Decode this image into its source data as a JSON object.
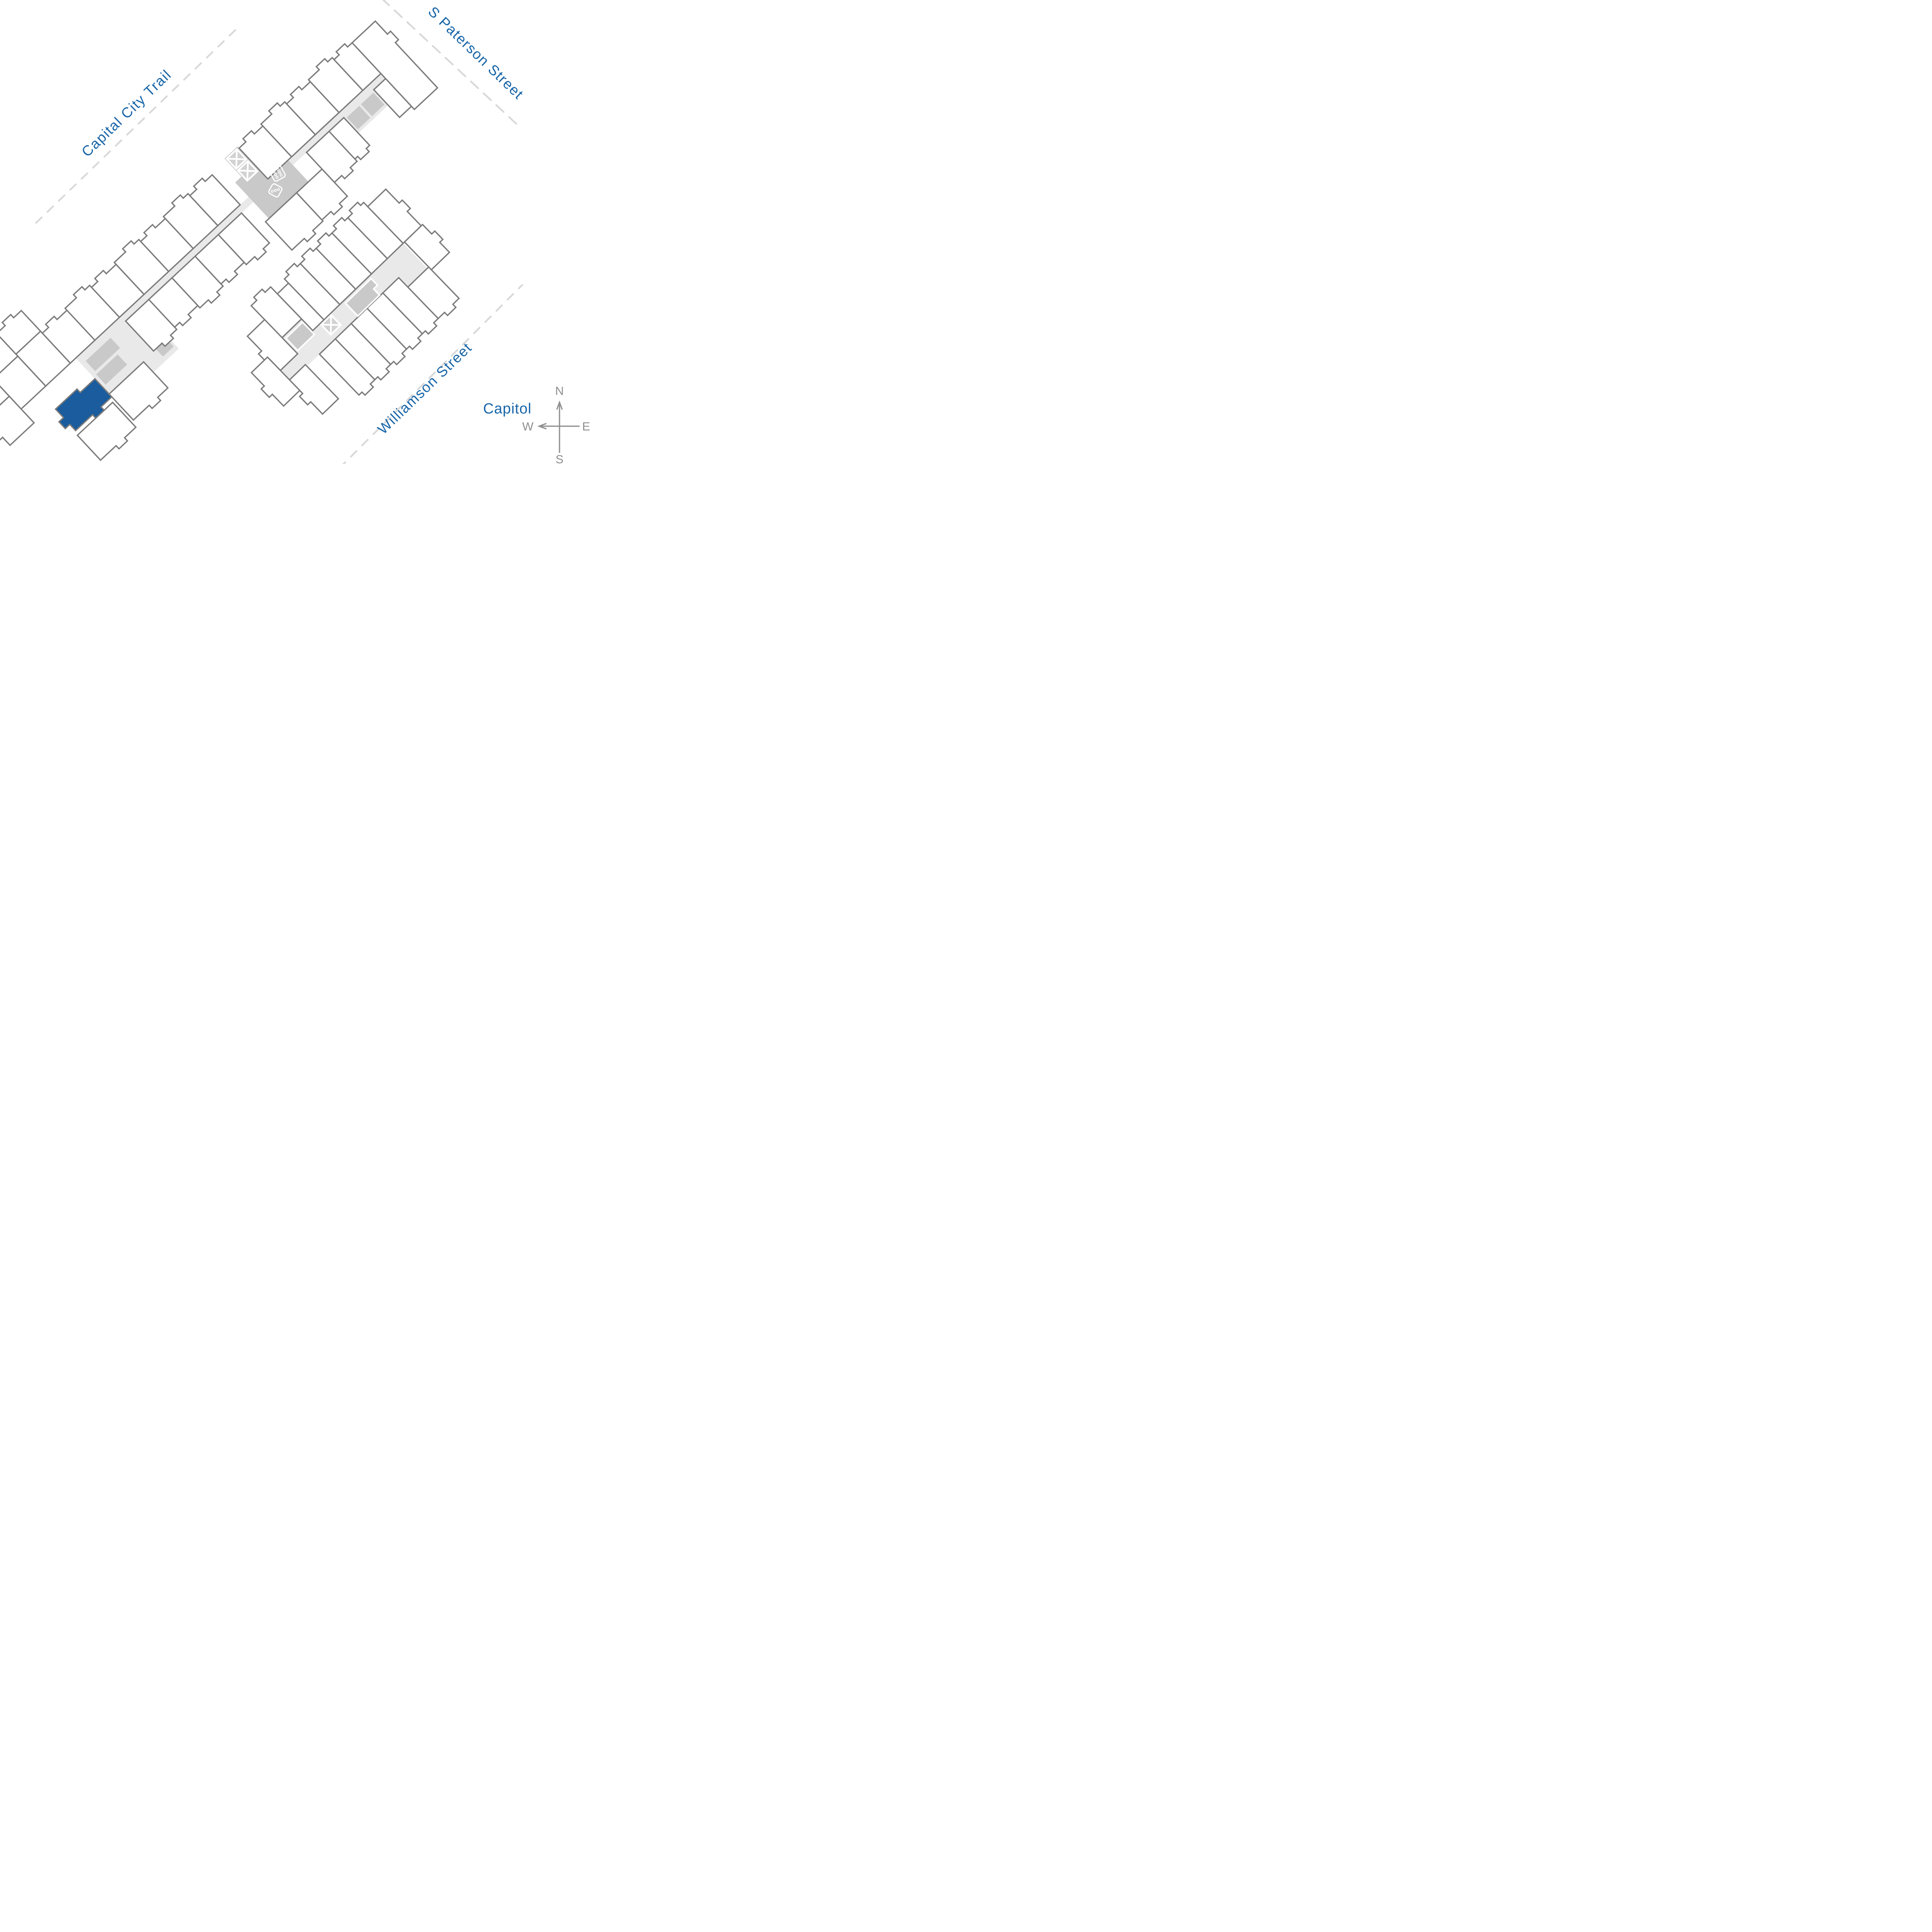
{
  "page": {
    "title": "Apartment community site plan"
  },
  "streets": {
    "capital_city_trail": "Capital City Trail",
    "s_paterson": "S Paterson Street",
    "williamson": "Williamson Street"
  },
  "landmark": {
    "capitol": "Capitol"
  },
  "compass": {
    "n": "N",
    "e": "E",
    "w": "W",
    "s": "S"
  },
  "highlighted_unit": {
    "building": "west-wing",
    "state": "selected",
    "color": "#1A5C9E"
  },
  "icons": [
    {
      "name": "dice-icon",
      "meaning": "game room amenity"
    },
    {
      "name": "stair-x-icon",
      "meaning": "stairwell"
    },
    {
      "name": "compass-rose",
      "meaning": "map orientation"
    }
  ],
  "colors": {
    "street_label": "#1765A8",
    "highlight_unit": "#1A5C9E",
    "unit_outline": "#7B7B7B",
    "corridor": "#E9E9E9",
    "amenity": "#C9C9C9",
    "xbox": "#D2D2D2",
    "dashed_line": "#D8D8D8",
    "compass": "#8F8F8F"
  }
}
